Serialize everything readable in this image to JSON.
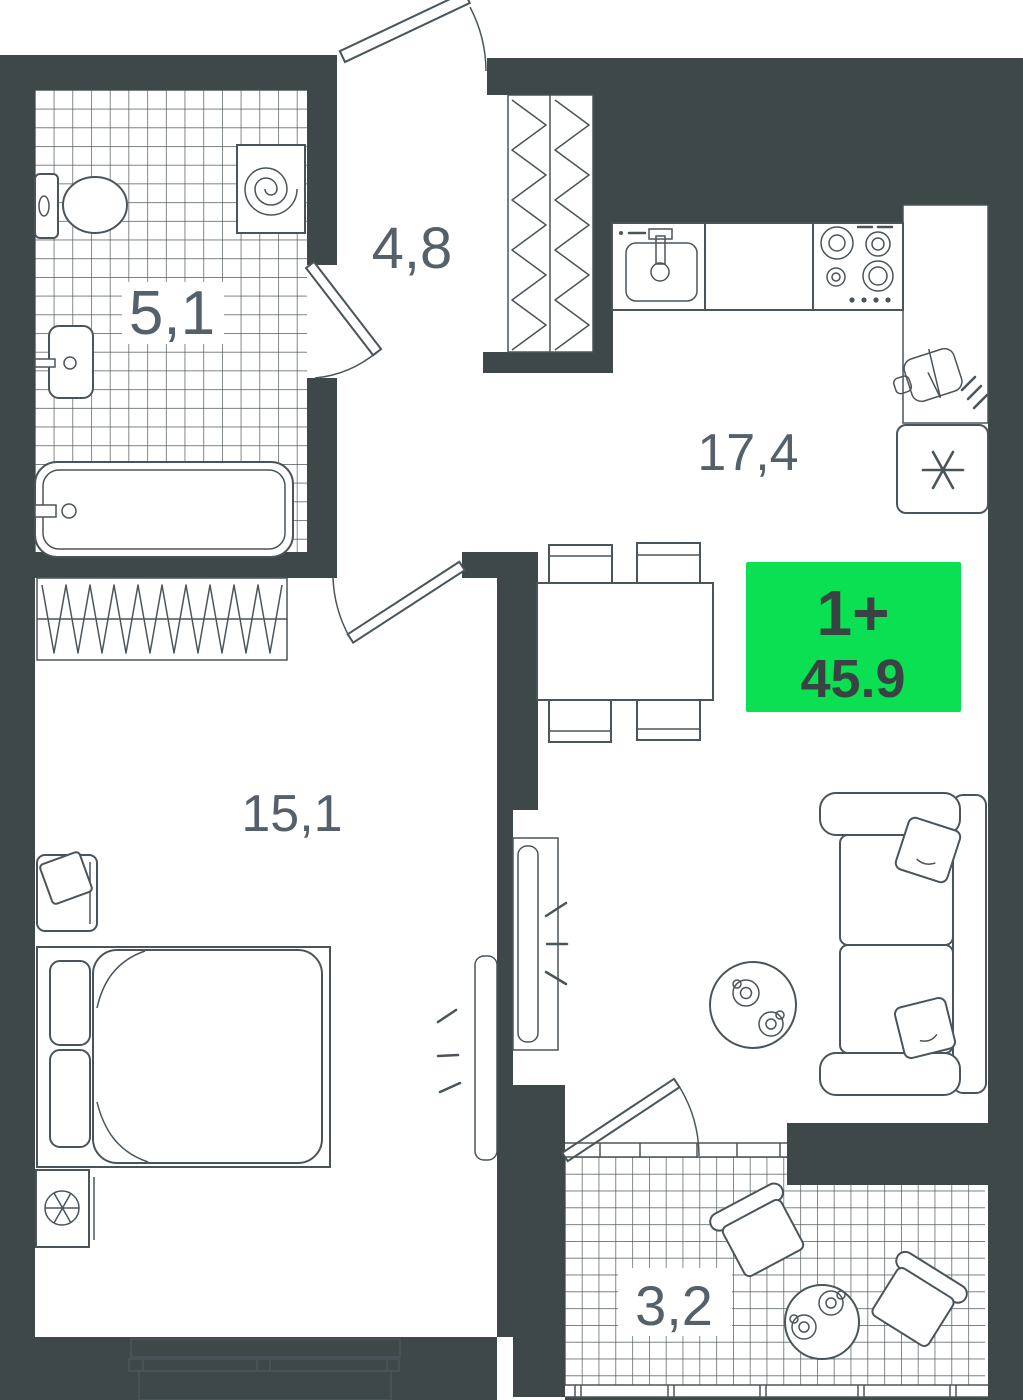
{
  "plan": {
    "title": "apartment-floor-plan",
    "badge": {
      "type_label": "1+",
      "total_area": "45.9"
    },
    "rooms": [
      {
        "id": "bathroom",
        "area_label": "5,1"
      },
      {
        "id": "hallway",
        "area_label": "4,8"
      },
      {
        "id": "kitchen-living",
        "area_label": "17,4"
      },
      {
        "id": "bedroom",
        "area_label": "15,1"
      },
      {
        "id": "balcony",
        "area_label": "3,2"
      }
    ],
    "colors": {
      "wall": "#3E4849",
      "outline": "#4A555B",
      "room_label": "#55606A",
      "badge_bg": "#0AE052",
      "badge_text": "#3A4344",
      "floor": "#FFFFFF"
    },
    "icons": {
      "washing_machine": "spiral",
      "fridge": "snowflake ✳",
      "cutting_board": "board + knife",
      "fan_vent": "crossed circle",
      "stove": "4 burners",
      "tv_signal": "3 dashes"
    }
  }
}
